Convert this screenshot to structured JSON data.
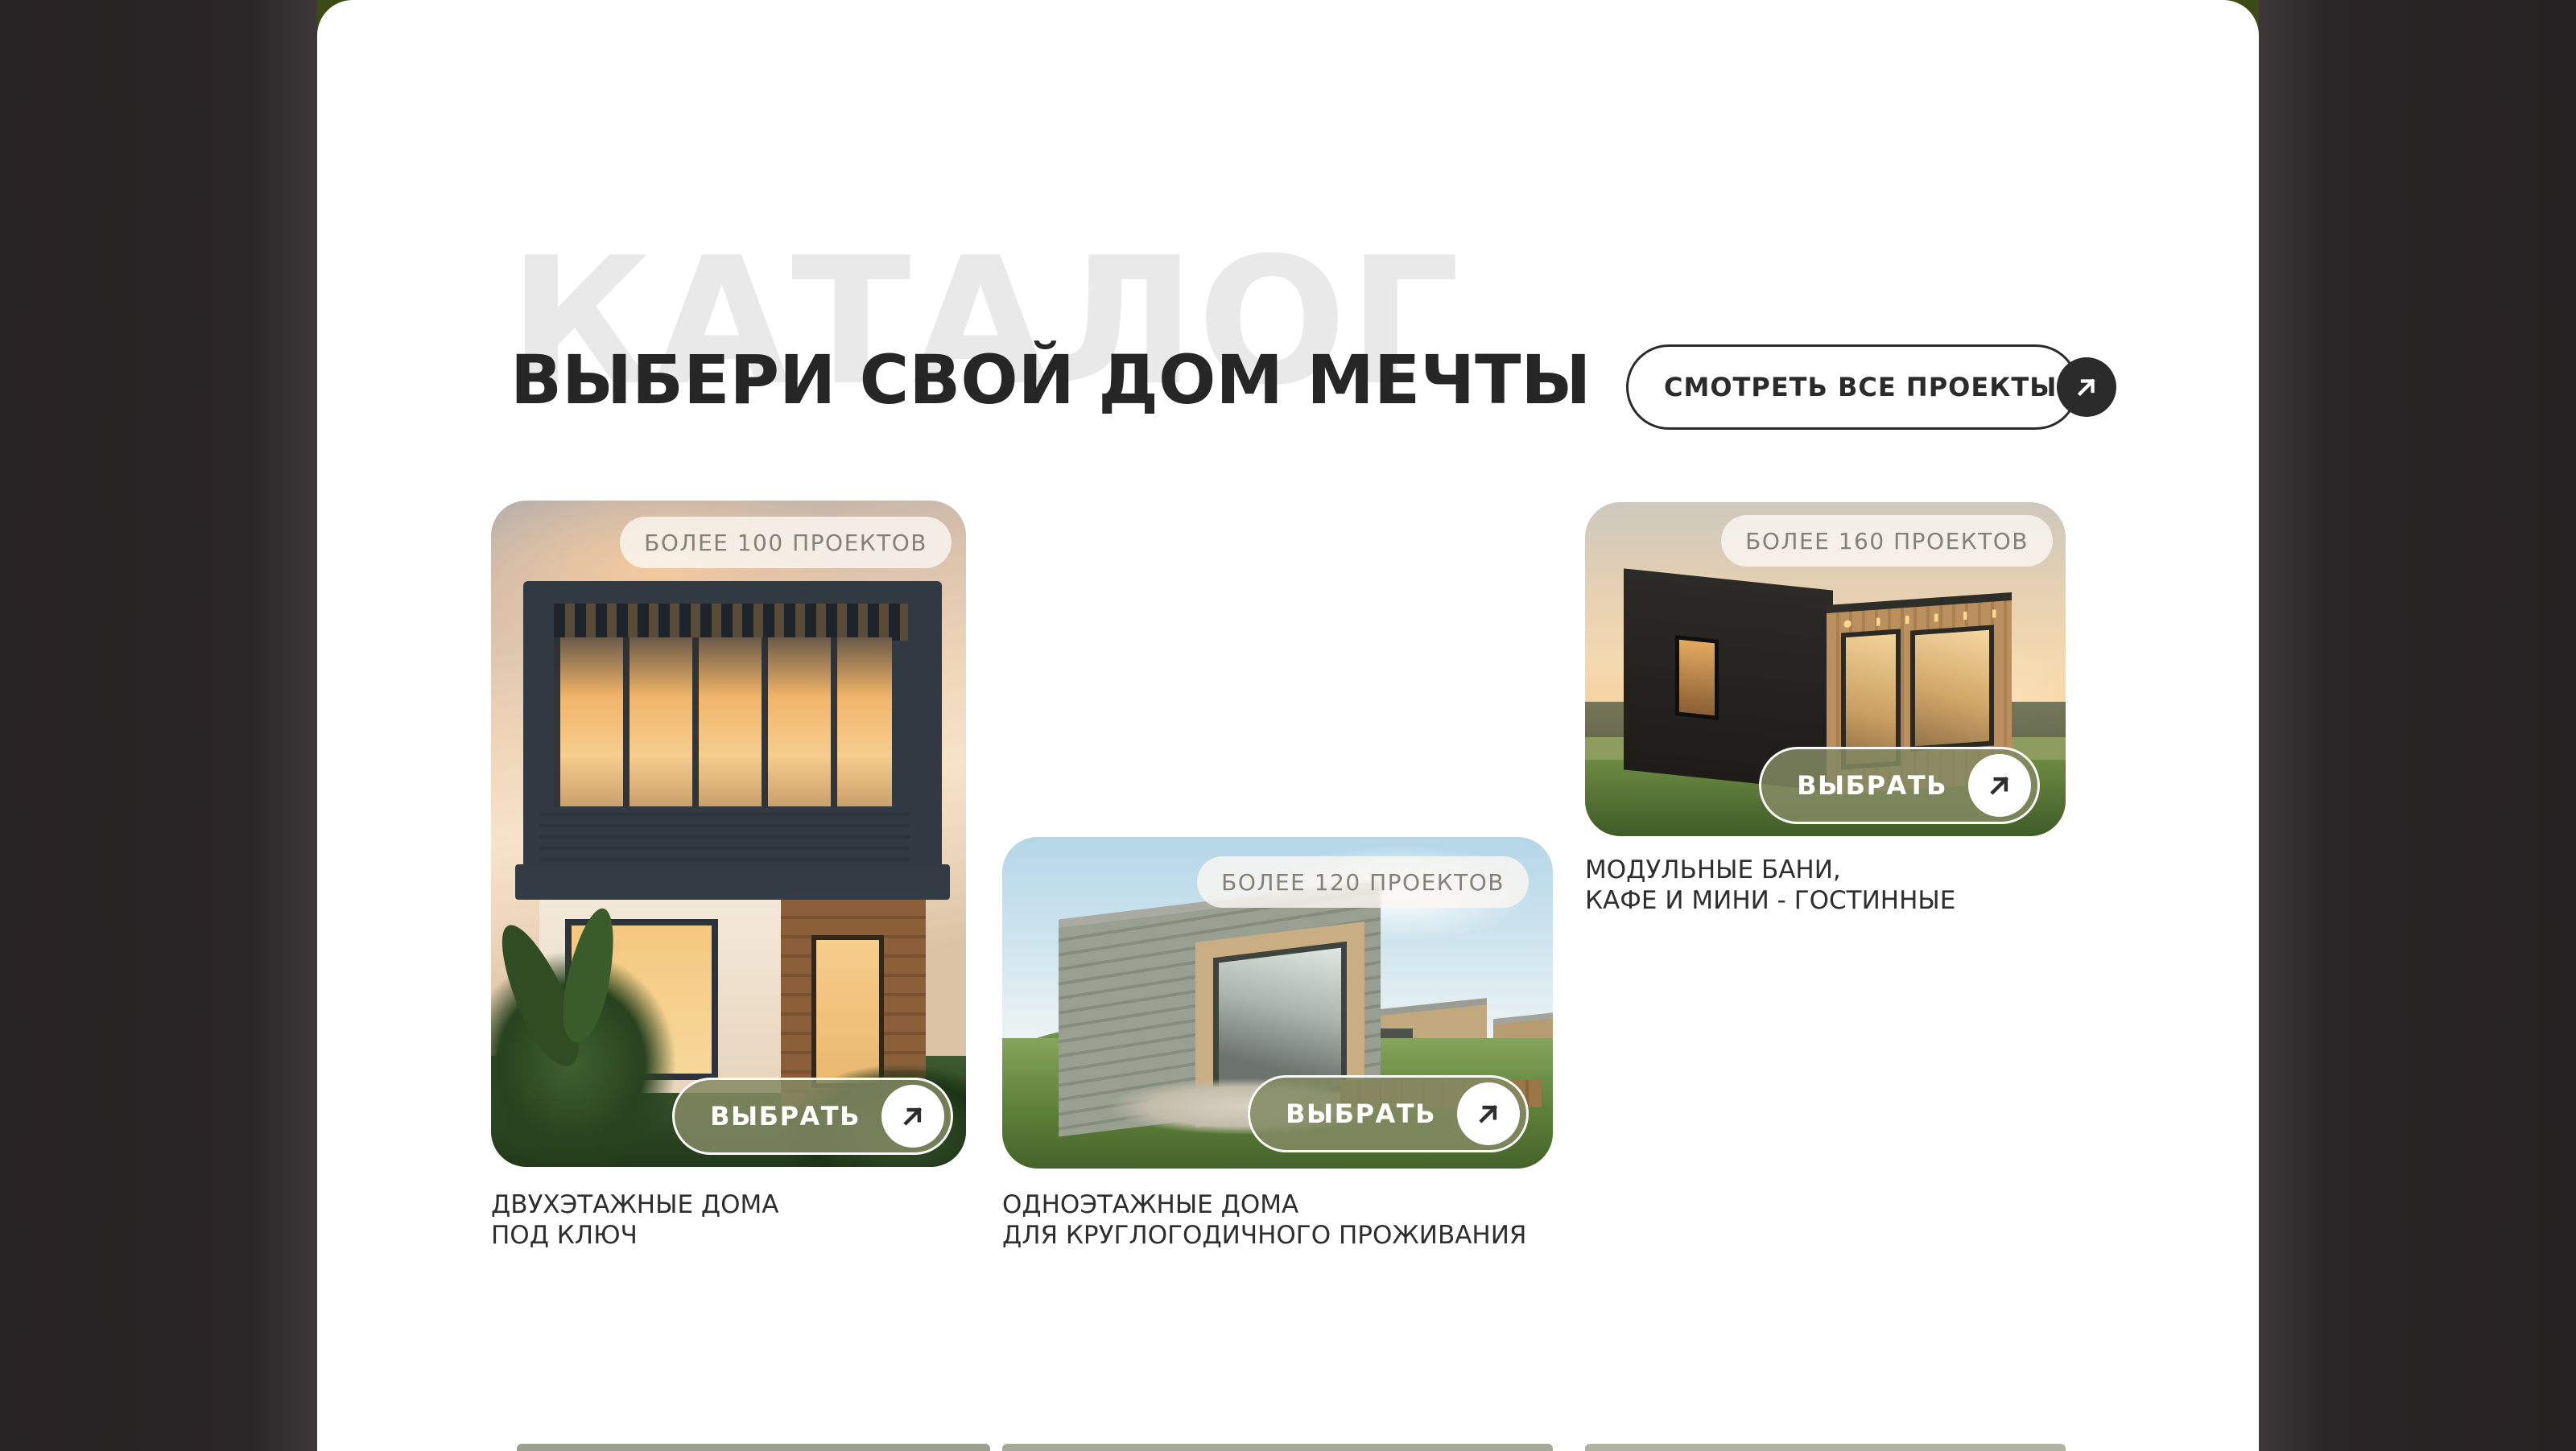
{
  "section": {
    "watermark": "КАТАЛОГ",
    "title": "ВЫБЕРИ СВОЙ ДОМ МЕЧТЫ",
    "view_all_label": "СМОТРЕТЬ ВСЕ ПРОЕКТЫ"
  },
  "cards": [
    {
      "badge": "БОЛЕЕ 100 ПРОЕКТОВ",
      "button_label": "ВЫБРАТЬ",
      "caption_line1": "ДВУХЭТАЖНЫЕ ДОМА",
      "caption_line2": "ПОД КЛЮЧ",
      "photo_alt": "двухэтажный дом"
    },
    {
      "badge": "БОЛЕЕ 120 ПРОЕКТОВ",
      "button_label": "ВЫБРАТЬ",
      "caption_line1": "ОДНОЭТАЖНЫЕ ДОМА",
      "caption_line2": "ДЛЯ КРУГЛОГОДИЧНОГО ПРОЖИВАНИЯ",
      "photo_alt": "одноэтажные дома"
    },
    {
      "badge": "БОЛЕЕ 160 ПРОЕКТОВ",
      "button_label": "ВЫБРАТЬ",
      "caption_line1": "МОДУЛЬНЫЕ БАНИ,",
      "caption_line2": "КАФЕ И МИНИ - ГОСТИННЫЕ",
      "photo_alt": "модульная баня"
    }
  ],
  "colors": {
    "side_band": "#2a2526",
    "sheet": "#ffffff",
    "watermark": "#e9e9e9",
    "heading": "#262626",
    "accent_button": "#828963",
    "badge_text": "#84807a",
    "corner_green": "#3d4a16"
  }
}
